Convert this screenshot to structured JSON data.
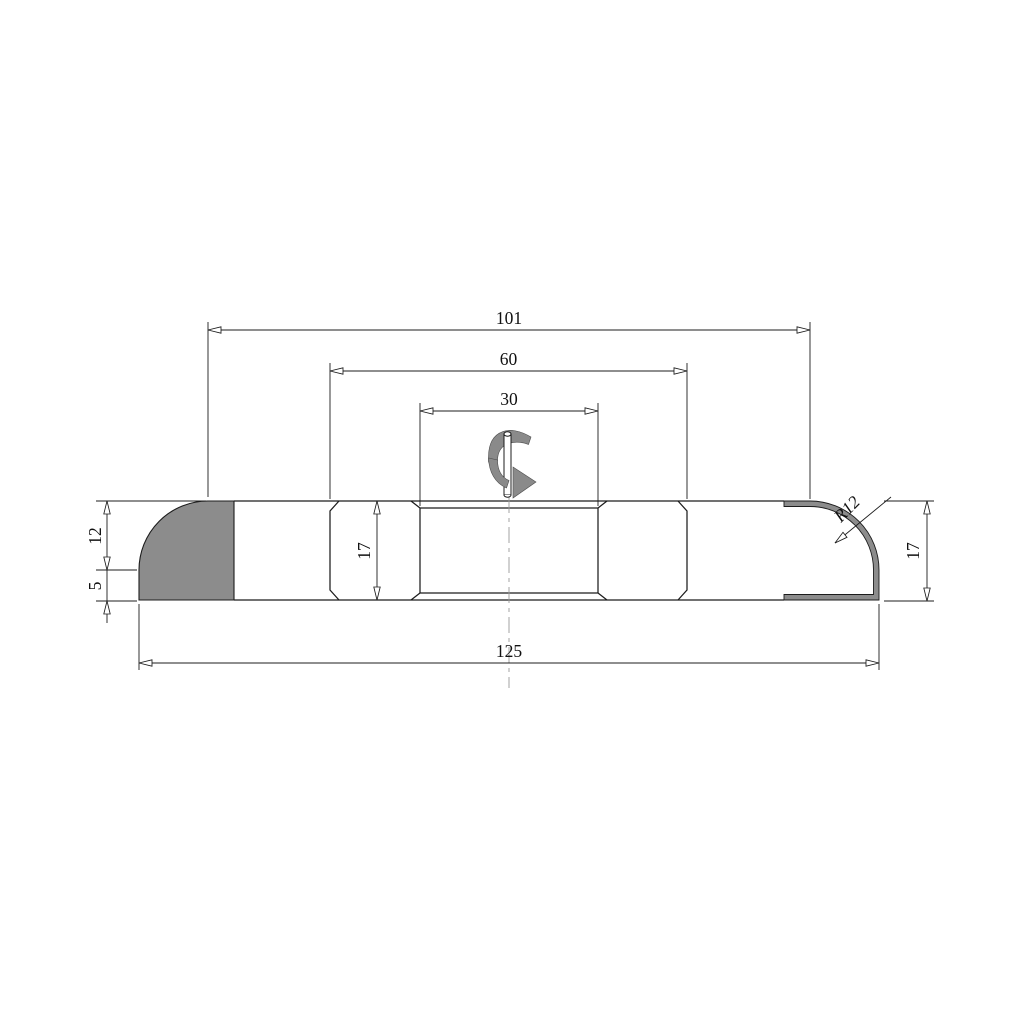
{
  "drawing": {
    "description": "technical-drawing-rotary-cutter-profile",
    "colors": {
      "line": "#1c1c1c",
      "profile_fill": "#8c8c8c",
      "rotation_arrow_fill": "#8a8a8a",
      "background": "#ffffff"
    },
    "dims": {
      "overall_length": "125",
      "profile_span": "101",
      "hub_width": "60",
      "bore_width": "30",
      "left_radius_height": "12",
      "left_base_height": "5",
      "body_height_mid": "17",
      "body_height_right": "17",
      "corner_radius": "R12"
    }
  }
}
